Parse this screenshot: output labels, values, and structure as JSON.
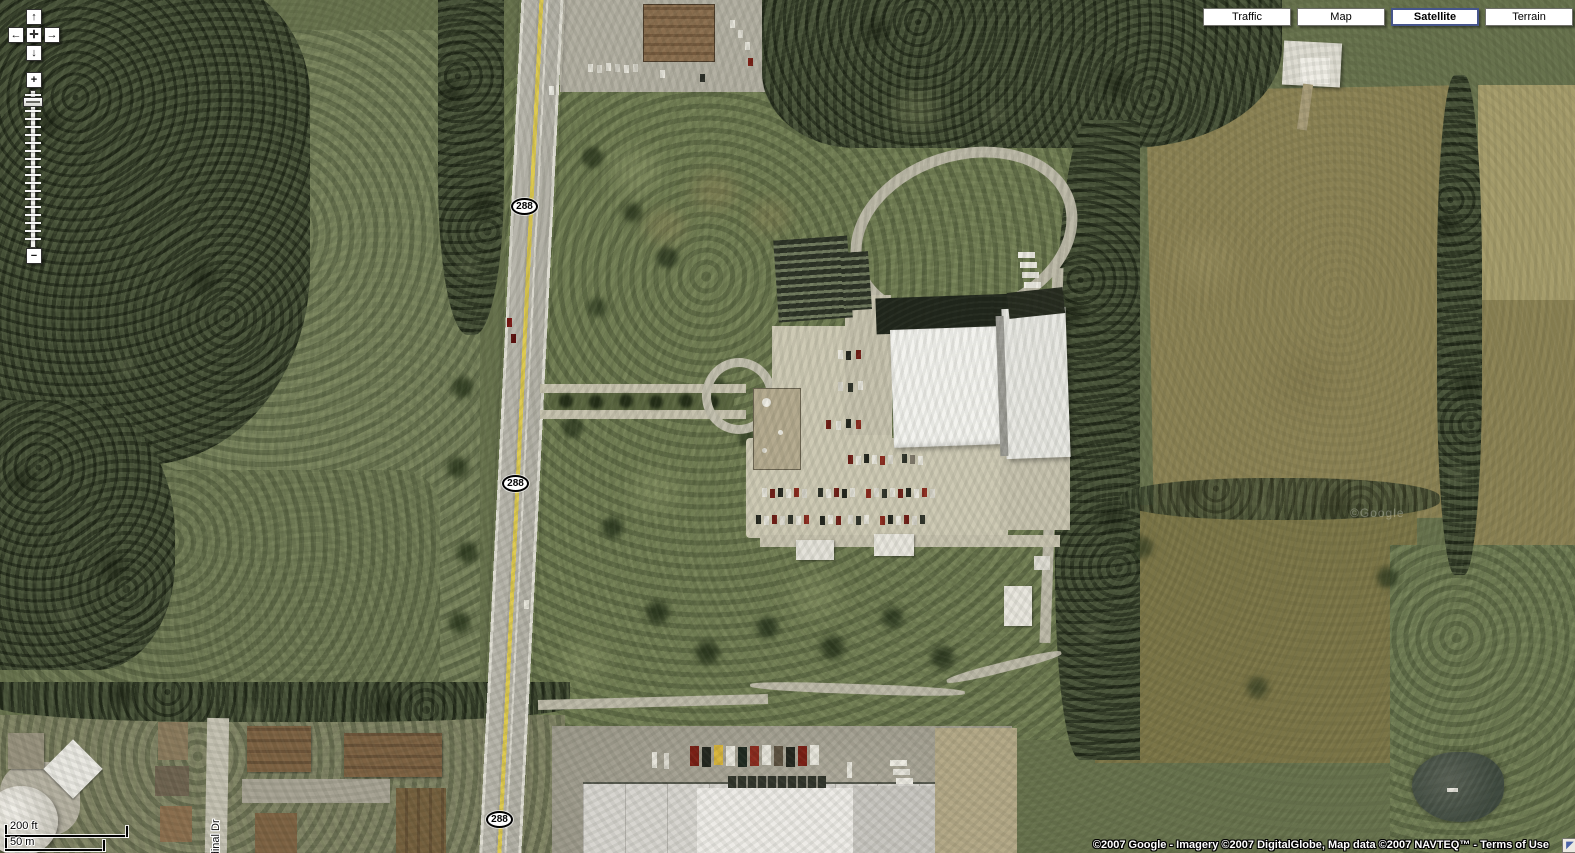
{
  "view_buttons": {
    "traffic": "Traffic",
    "map": "Map",
    "satellite": "Satellite",
    "terrain": "Terrain",
    "selected": "Satellite"
  },
  "icons": {
    "pan_up": "↑",
    "pan_left": "←",
    "pan_right": "→",
    "pan_down": "↓",
    "pan_center": "✛",
    "zoom_in": "+",
    "zoom_out": "−",
    "overview_toggle": "◤"
  },
  "scale_bar": {
    "imperial": "200 ft",
    "metric": "50 m"
  },
  "map_labels": {
    "route_shields": [
      "288",
      "288",
      "288"
    ],
    "street": "Cardinal Dr",
    "watermark": "©Google"
  },
  "attribution": {
    "prefix": "©2007 Google - Imagery ©2007 DigitalGlobe, Map data ©2007 NAVTEQ™ - ",
    "terms_link": "Terms of Use"
  },
  "colors": {
    "selected_view_border": "#46558c",
    "route_shield_bg": "#ffffff",
    "highway_stripe_yellow": "#ddc94f",
    "attribution_text": "#ffffff"
  }
}
